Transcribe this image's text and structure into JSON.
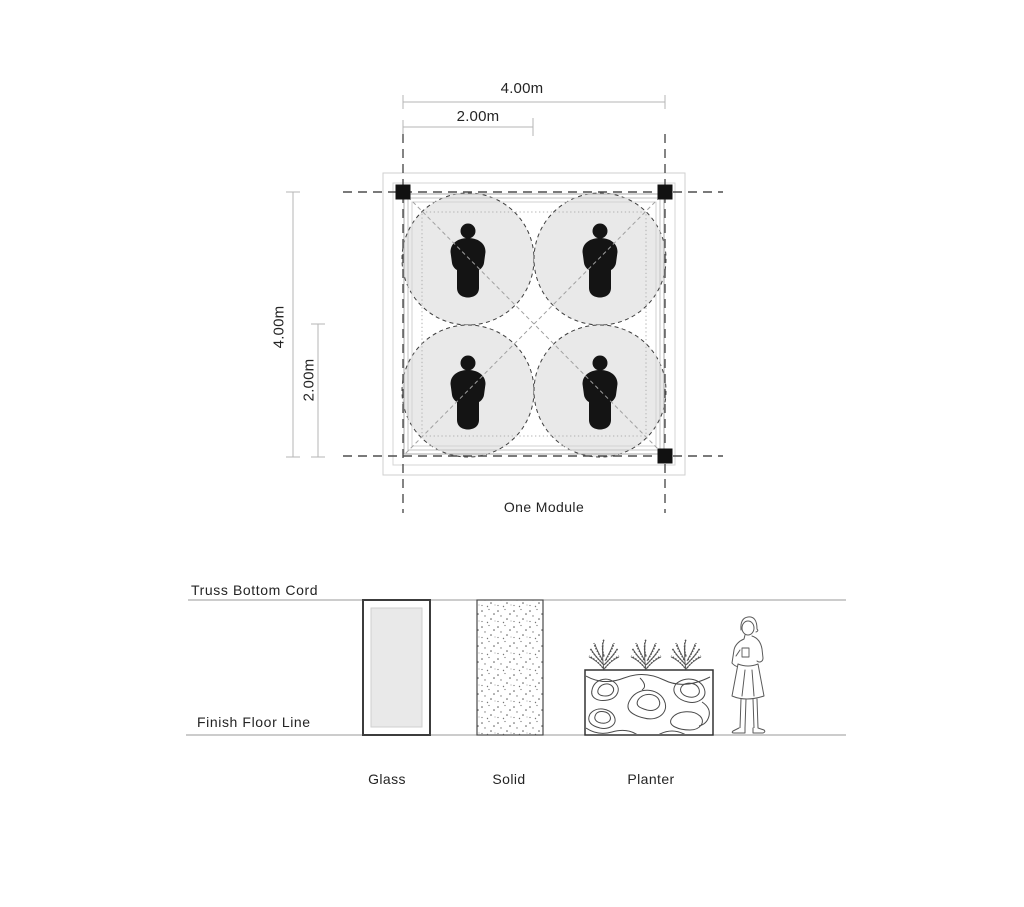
{
  "plan": {
    "module_label": "One Module",
    "dimensions": {
      "width_total": "4.00m",
      "width_half": "2.00m",
      "height_total": "4.00m",
      "height_half": "2.00m"
    },
    "occupant_count": 4,
    "column_count": 3
  },
  "elevation": {
    "top_line_label": "Truss Bottom Cord",
    "bottom_line_label": "Finish Floor Line",
    "elements": [
      {
        "label": "Glass"
      },
      {
        "label": "Solid"
      },
      {
        "label": "Planter"
      }
    ]
  },
  "colors": {
    "background": "#ffffff",
    "frame_light": "#cfcfcf",
    "grid_dash": "#4f4f4f",
    "circle_fill": "#e9e9e9",
    "circle_stroke": "#3f3f3f",
    "person_fill": "#141414",
    "dimension_line": "#b5b5b5",
    "elevation_line": "#9a9a9a",
    "ink": "#242424"
  }
}
